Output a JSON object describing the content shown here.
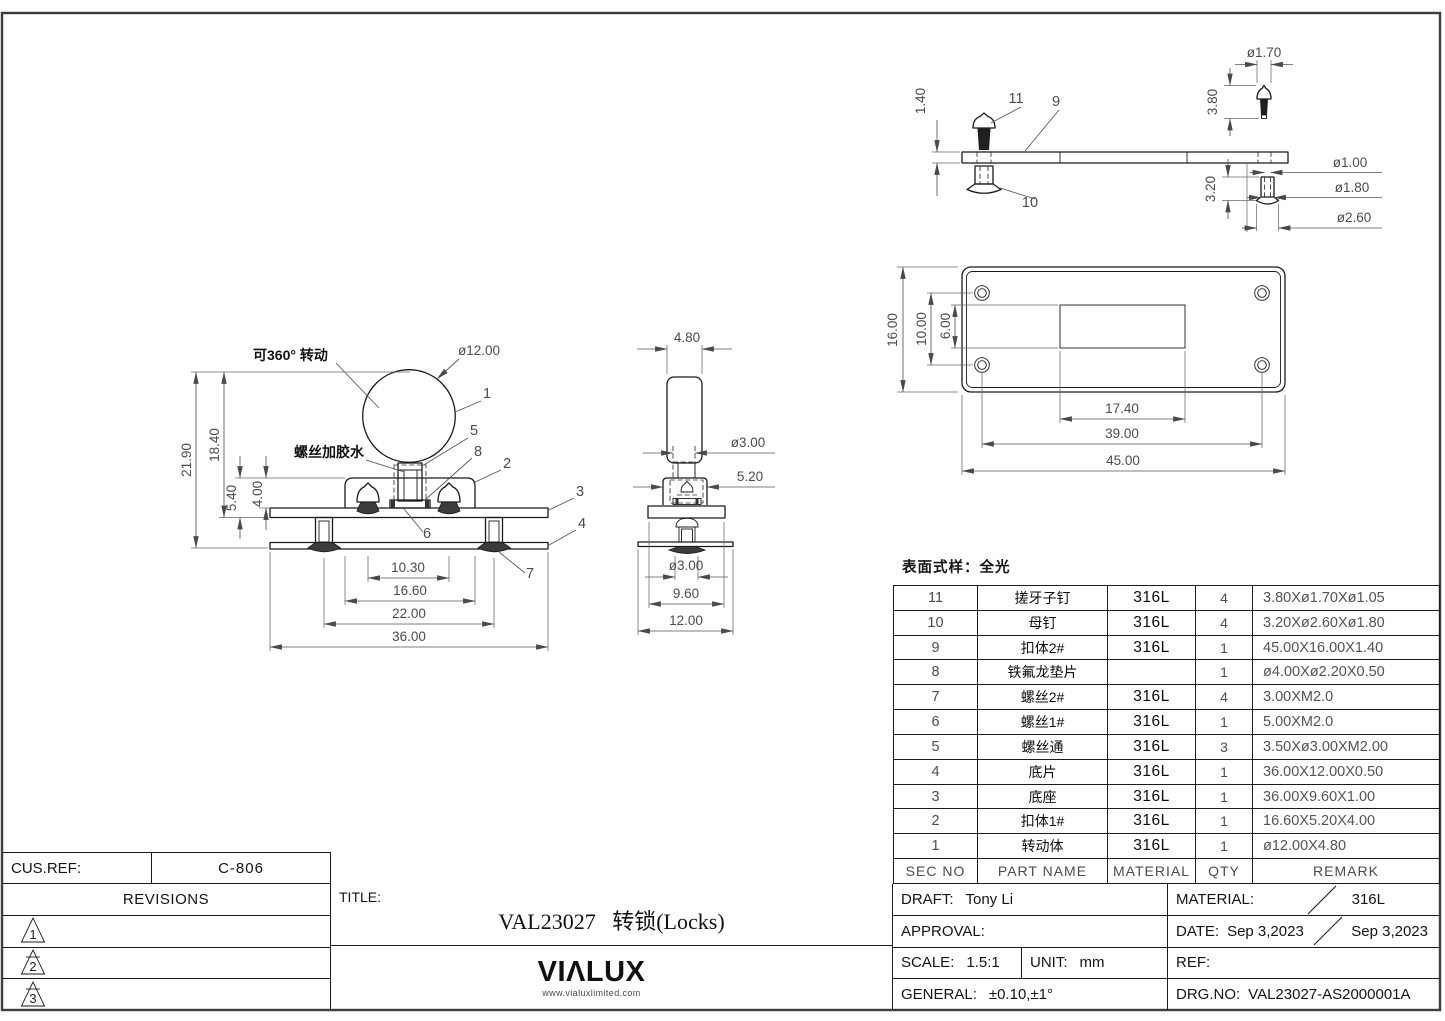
{
  "sheet": {
    "surface_note": "表面式样：全光"
  },
  "front_view": {
    "note_rotate": "可360° 转动",
    "note_glue": "螺丝加胶水",
    "dia": "ø12.00",
    "callouts": {
      "c1": "1",
      "c2": "2",
      "c3": "3",
      "c4": "4",
      "c5": "5",
      "c6": "6",
      "c7": "7",
      "c8": "8"
    },
    "dims": {
      "total_height": "21.90",
      "upper_height": "18.40",
      "base_height": "5.40",
      "body_height": "4.00",
      "screw_span": "10.30",
      "body_width": "16.60",
      "outer_screw_span": "22.00",
      "plate_width": "36.00"
    }
  },
  "side_view": {
    "dims": {
      "knob_width": "4.80",
      "screw_dia": "ø3.00",
      "body_width": "5.20",
      "bottom_screw_dia": "ø3.00",
      "base_width": "9.60",
      "plate_width": "12.00"
    }
  },
  "latch_view": {
    "callouts": {
      "c9": "9",
      "c10": "10",
      "c11": "11"
    },
    "dims": {
      "bar_thickness": "1.40",
      "pin_head_dia": "ø1.70",
      "pin_length": "3.80",
      "nut_length": "3.20",
      "nut_hole_dia": "ø1.00",
      "nut_shaft_dia": "ø1.80",
      "nut_head_dia": "ø2.60"
    }
  },
  "plate_view": {
    "dims": {
      "height": "16.00",
      "hole_span_v": "10.00",
      "slot_height": "6.00",
      "slot_width": "17.40",
      "hole_span_h": "39.00",
      "width": "45.00"
    }
  },
  "bom": {
    "headers": {
      "sec": "SEC NO",
      "name": "PART NAME",
      "material": "MATERIAL",
      "qty": "QTY",
      "remark": "REMARK"
    },
    "rows": [
      {
        "sec": "11",
        "name": "搓牙子钉",
        "material": "316L",
        "qty": "4",
        "remark": "3.80Xø1.70Xø1.05"
      },
      {
        "sec": "10",
        "name": "母钉",
        "material": "316L",
        "qty": "4",
        "remark": "3.20Xø2.60Xø1.80"
      },
      {
        "sec": "9",
        "name": "扣体2#",
        "material": "316L",
        "qty": "1",
        "remark": "45.00X16.00X1.40"
      },
      {
        "sec": "8",
        "name": "铁氟龙垫片",
        "material": "",
        "qty": "1",
        "remark": "ø4.00Xø2.20X0.50"
      },
      {
        "sec": "7",
        "name": "螺丝2#",
        "material": "316L",
        "qty": "4",
        "remark": "3.00XM2.0"
      },
      {
        "sec": "6",
        "name": "螺丝1#",
        "material": "316L",
        "qty": "1",
        "remark": "5.00XM2.0"
      },
      {
        "sec": "5",
        "name": "螺丝通",
        "material": "316L",
        "qty": "3",
        "remark": "3.50Xø3.00XM2.00"
      },
      {
        "sec": "4",
        "name": "底片",
        "material": "316L",
        "qty": "1",
        "remark": "36.00X12.00X0.50"
      },
      {
        "sec": "3",
        "name": "底座",
        "material": "316L",
        "qty": "1",
        "remark": "36.00X9.60X1.00"
      },
      {
        "sec": "2",
        "name": "扣体1#",
        "material": "316L",
        "qty": "1",
        "remark": "16.60X5.20X4.00"
      },
      {
        "sec": "1",
        "name": "转动体",
        "material": "316L",
        "qty": "1",
        "remark": "ø12.00X4.80"
      }
    ]
  },
  "title_block": {
    "cus_ref_label": "CUS.REF:",
    "cus_ref_value": "C-806",
    "revisions_label": "REVISIONS",
    "revisions": [
      "1",
      "2",
      "3"
    ],
    "title_label": "TITLE:",
    "title": "VAL23027   转锁(Locks)",
    "logo": "VIΛLUX",
    "logo_url": "www.vialuxlimited.com",
    "draft_label": "DRAFT:",
    "draft_value": "Tony Li",
    "approval_label": "APPROVAL:",
    "scale_label": "SCALE:",
    "scale_value": "1.5:1",
    "unit_label": "UNIT:",
    "unit_value": "mm",
    "general_label": "GENERAL:",
    "general_value": "±0.10,±1°",
    "material_label": "MATERIAL:",
    "material_value": "316L",
    "date_label": "DATE:",
    "date_value": "Sep 3,2023",
    "date_value2": "Sep 3,2023",
    "ref_label": "REF:",
    "drg_label": "DRG.NO:",
    "drg_value": "VAL23027-AS2000001A"
  }
}
